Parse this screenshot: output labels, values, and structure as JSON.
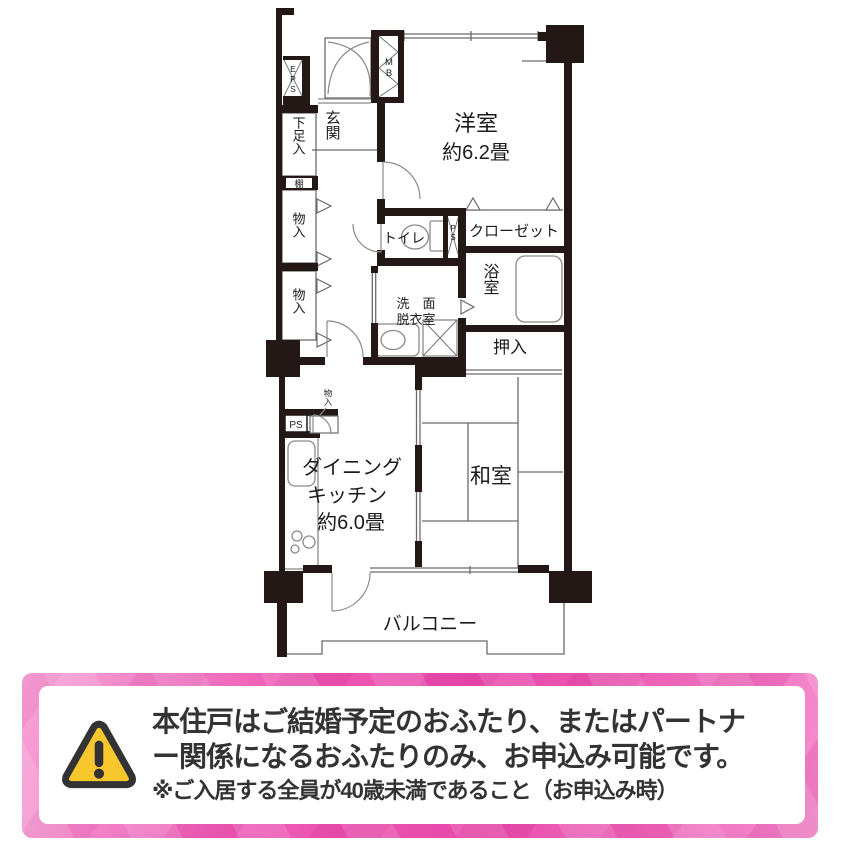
{
  "floorplan": {
    "labels": {
      "western_room": "洋室",
      "western_room_size": "約6.2畳",
      "dining_line1": "ダイニング",
      "dining_line2": "キッチン",
      "dining_size": "約6.0畳",
      "japanese_room": "和室",
      "balcony": "バルコニー",
      "entrance": "玄関",
      "shoe_cabinet": "下足入",
      "shelf": "棚",
      "storage_1": "物入",
      "storage_2": "物入",
      "storage_dk": "物入",
      "toilet": "トイレ",
      "closet": "クローゼット",
      "bathroom": "浴室",
      "washroom_line1": "洗　面",
      "washroom_line2": "脱衣室",
      "oshiire": "押入",
      "eps": "EPS",
      "mb": "MB",
      "ps_upper": "PS",
      "ps_kitchen": "PS"
    }
  },
  "notice": {
    "line1": "本住戸はご結婚予定のおふたり、またはパートナ",
    "line2": "ー関係になるおふたりのみ、お申込み可能です。",
    "line3": "※ご入居する全員が40歳未満であること（お申込み時）",
    "colors": {
      "frame_pink": "#EC58B2",
      "card_white": "#FFFFFF",
      "warning_yellow": "#F8C72E",
      "warning_outline": "#333333",
      "text": "#333333"
    }
  }
}
